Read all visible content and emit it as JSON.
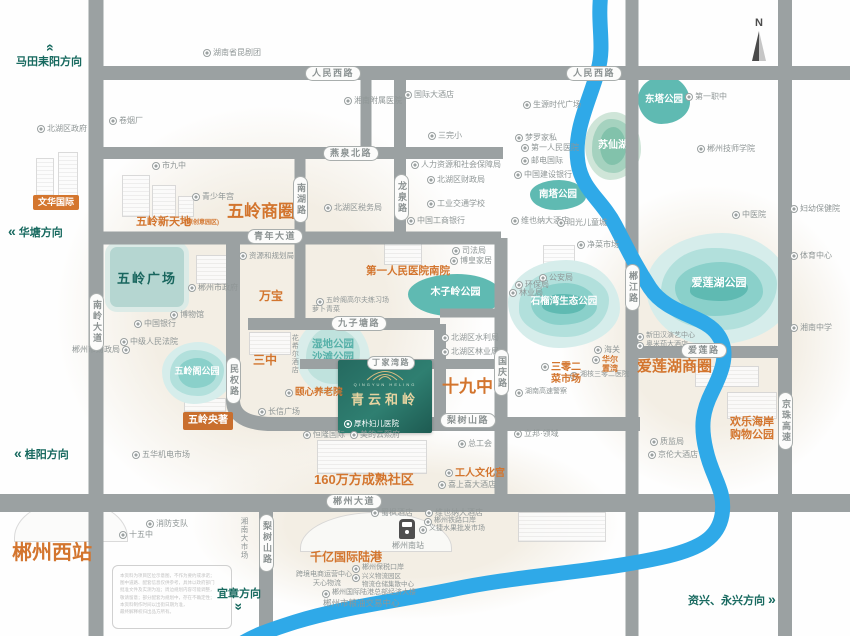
{
  "colors": {
    "road": "#9ba1a2",
    "river": "#2fa9e8",
    "orange": "#d3752e",
    "teal_dark": "#17695f",
    "park_palette": [
      "#d6edeb",
      "#b2e0dc",
      "#8ad0ca",
      "#5fbab2"
    ],
    "park_green": [
      "#cfe5d8",
      "#a5d2bf",
      "#82c2ab"
    ],
    "park_pale": [
      "#d9edea",
      "#bfe2dd"
    ]
  },
  "project": {
    "name": "青云和岭",
    "latin": "QINGYUN HELING",
    "hospital": "厚朴妇儿医院"
  },
  "compass": {
    "label": "N"
  },
  "road_pills": {
    "horizontal": [
      {
        "t": "人民西路",
        "x": 305,
        "y": 66
      },
      {
        "t": "人民西路",
        "x": 566,
        "y": 66
      },
      {
        "t": "燕泉北路",
        "x": 323,
        "y": 146
      },
      {
        "t": "青年大道",
        "x": 247,
        "y": 229
      },
      {
        "t": "九子塘路",
        "x": 331,
        "y": 316
      },
      {
        "t": "丁家湾路",
        "x": 367,
        "y": 356,
        "sm": 1
      },
      {
        "t": "梨树山路",
        "x": 440,
        "y": 413
      },
      {
        "t": "爱莲路",
        "x": 681,
        "y": 343
      },
      {
        "t": "郴州大道",
        "x": 326,
        "y": 494
      }
    ],
    "vertical": [
      {
        "t": "南岭大道",
        "x": 89,
        "y": 293
      },
      {
        "t": "南湖路",
        "x": 293,
        "y": 176
      },
      {
        "t": "龙泉路",
        "x": 394,
        "y": 174
      },
      {
        "t": "民权路",
        "x": 226,
        "y": 357
      },
      {
        "t": "国庆路",
        "x": 494,
        "y": 349
      },
      {
        "t": "郴江路",
        "x": 625,
        "y": 264
      },
      {
        "t": "京珠高速",
        "x": 778,
        "y": 392
      },
      {
        "t": "梨树山路",
        "x": 259,
        "y": 514
      }
    ]
  },
  "directions": [
    {
      "t": "马田耒阳方向",
      "x": 16,
      "y": 42,
      "dir": "up"
    },
    {
      "t": "华塘方向",
      "x": 8,
      "y": 224,
      "dir": "left"
    },
    {
      "t": "桂阳方向",
      "x": 14,
      "y": 446,
      "dir": "left"
    },
    {
      "t": "宜章方向",
      "x": 217,
      "y": 585,
      "dir": "down"
    },
    {
      "t": "资兴、永兴方向",
      "x": 688,
      "y": 592,
      "dir": "right"
    }
  ],
  "orange_labels": [
    {
      "t": "五岭商圈",
      "x": 227,
      "y": 202,
      "fs": 17
    },
    {
      "t": "爱莲湖商圈",
      "x": 637,
      "y": 358,
      "fs": 15
    },
    {
      "t": "十九中",
      "x": 442,
      "y": 377,
      "fs": 17
    },
    {
      "t": "郴州西站",
      "x": 12,
      "y": 542,
      "fs": 20
    },
    {
      "t": "160万方成熟社区",
      "x": 314,
      "y": 473,
      "fs": 13
    },
    {
      "t": "千亿国际陆港",
      "x": 310,
      "y": 551,
      "fs": 12
    },
    {
      "t": "五岭新天地",
      "x": 136,
      "y": 216,
      "fs": 11
    },
    {
      "t": "(原创意园区)",
      "x": 185,
      "y": 220,
      "fs": 6
    },
    {
      "t": "万宝",
      "x": 259,
      "y": 290,
      "fs": 12
    },
    {
      "t": "第一人民医院南院",
      "x": 366,
      "y": 265,
      "fs": 10.5
    },
    {
      "t": "三中",
      "x": 253,
      "y": 354,
      "fs": 12
    },
    {
      "t": "欢乐海岸\n购物公园",
      "x": 730,
      "y": 416,
      "fs": 11
    },
    {
      "t": "工人文化宫",
      "x": 445,
      "y": 468,
      "fs": 10,
      "icon": 1
    },
    {
      "t": "颐心养老院",
      "x": 285,
      "y": 388,
      "fs": 9.5,
      "icon": 1
    },
    {
      "t": "三零二\n菜市场",
      "x": 541,
      "y": 362,
      "fs": 10,
      "icon": 1
    },
    {
      "t": "华尔\n置湾",
      "x": 592,
      "y": 355,
      "fs": 8,
      "icon": 1
    }
  ],
  "pois": [
    {
      "t": "北湖区政府",
      "x": 37,
      "y": 124
    },
    {
      "t": "卷烟厂",
      "x": 109,
      "y": 116
    },
    {
      "t": "湖南省昆剧团",
      "x": 203,
      "y": 48
    },
    {
      "t": "市九中",
      "x": 152,
      "y": 161
    },
    {
      "t": "青少年宫",
      "x": 192,
      "y": 192
    },
    {
      "t": "湘南附属医院",
      "x": 344,
      "y": 96
    },
    {
      "t": "国际大酒店",
      "x": 404,
      "y": 90
    },
    {
      "t": "三完小",
      "x": 428,
      "y": 131
    },
    {
      "t": "人力资源和社会保障局",
      "x": 411,
      "y": 160
    },
    {
      "t": "北湖区财政局",
      "x": 427,
      "y": 175
    },
    {
      "t": "北湖区税务局",
      "x": 324,
      "y": 203
    },
    {
      "t": "工业交通学校",
      "x": 427,
      "y": 199
    },
    {
      "t": "中国工商银行",
      "x": 407,
      "y": 216
    },
    {
      "t": "生源时代广场",
      "x": 523,
      "y": 100
    },
    {
      "t": "梦罗家私",
      "x": 515,
      "y": 133
    },
    {
      "t": "第一人民医院",
      "x": 521,
      "y": 143
    },
    {
      "t": "邮电国际",
      "x": 521,
      "y": 156
    },
    {
      "t": "中国建设银行",
      "x": 514,
      "y": 170
    },
    {
      "t": "维也纳大酒店",
      "x": 511,
      "y": 216
    },
    {
      "t": "阳光儿童城",
      "x": 557,
      "y": 218
    },
    {
      "t": "第一职中",
      "x": 685,
      "y": 92
    },
    {
      "t": "郴州技师学院",
      "x": 697,
      "y": 144
    },
    {
      "t": "中医院",
      "x": 732,
      "y": 210
    },
    {
      "t": "妇幼保健院",
      "x": 790,
      "y": 204
    },
    {
      "t": "净菜市场",
      "x": 577,
      "y": 240
    },
    {
      "t": "体育中心",
      "x": 790,
      "y": 251
    },
    {
      "t": "湘南中学",
      "x": 790,
      "y": 323
    },
    {
      "t": "新田汉演艺中心",
      "x": 636,
      "y": 332,
      "fs": 7
    },
    {
      "t": "奥米茄大酒店",
      "x": 636,
      "y": 341,
      "fs": 7
    },
    {
      "t": "海关",
      "x": 594,
      "y": 345
    },
    {
      "t": "湘核三零二医院",
      "x": 570,
      "y": 371,
      "fs": 7
    },
    {
      "t": "湖南高速警察",
      "x": 515,
      "y": 388,
      "fs": 7
    },
    {
      "t": "司法局",
      "x": 452,
      "y": 246
    },
    {
      "t": "博皇家居",
      "x": 450,
      "y": 256
    },
    {
      "t": "公安局",
      "x": 539,
      "y": 273
    },
    {
      "t": "环保局",
      "x": 515,
      "y": 280
    },
    {
      "t": "林业局",
      "x": 509,
      "y": 288
    },
    {
      "t": "北湖区水利局",
      "x": 441,
      "y": 333
    },
    {
      "t": "北湖区林业局",
      "x": 441,
      "y": 347
    },
    {
      "t": "立邦·领域",
      "x": 514,
      "y": 429
    },
    {
      "t": "质监局",
      "x": 650,
      "y": 437
    },
    {
      "t": "京伦大酒店",
      "x": 648,
      "y": 450
    },
    {
      "t": "恒隆国际",
      "x": 303,
      "y": 430
    },
    {
      "t": "美的云熙府",
      "x": 350,
      "y": 430
    },
    {
      "t": "蜀枫酒店",
      "x": 371,
      "y": 508
    },
    {
      "t": "维也纳大酒店",
      "x": 425,
      "y": 508
    },
    {
      "t": "郴州铁路口岸",
      "x": 424,
      "y": 517,
      "fs": 7
    },
    {
      "t": "义捷水果批发市场",
      "x": 419,
      "y": 525,
      "fs": 7
    },
    {
      "t": "总工会",
      "x": 458,
      "y": 439
    },
    {
      "t": "喜上喜大酒店",
      "x": 438,
      "y": 480
    },
    {
      "t": "消防支队",
      "x": 146,
      "y": 519
    },
    {
      "t": "十五中",
      "x": 119,
      "y": 530
    },
    {
      "t": "长信广场",
      "x": 258,
      "y": 407
    },
    {
      "t": "中国银行",
      "x": 134,
      "y": 319
    },
    {
      "t": "博物馆",
      "x": 170,
      "y": 310
    },
    {
      "t": "郴州市政府",
      "x": 188,
      "y": 283
    },
    {
      "t": "中级人民法院",
      "x": 120,
      "y": 337
    },
    {
      "t": "郴州市财政局",
      "x": 72,
      "y": 345,
      "iconright": 1
    },
    {
      "t": "五华机电市场",
      "x": 132,
      "y": 450
    },
    {
      "t": "五岭阁高尔夫练习场",
      "x": 316,
      "y": 297,
      "fs": 7
    },
    {
      "t": "萝卜青菜",
      "x": 312,
      "y": 306,
      "fs": 7,
      "noicon": 1
    },
    {
      "t": "资源和规划局",
      "x": 239,
      "y": 251,
      "fs": 7.5
    },
    {
      "t": "郴州南站",
      "x": 392,
      "y": 541,
      "noicon": 1
    },
    {
      "t": "郴州保税口岸",
      "x": 352,
      "y": 564,
      "fs": 7
    },
    {
      "t": "跨境电商运营中心",
      "x": 296,
      "y": 571,
      "fs": 7,
      "noicon": 1
    },
    {
      "t": "天心物流",
      "x": 313,
      "y": 580,
      "fs": 7,
      "noicon": 1
    },
    {
      "t": "兴义物流园区\n物流仓储集散中心",
      "x": 352,
      "y": 573,
      "fs": 6.5
    },
    {
      "t": "郴州国际陆港总部经济大楼",
      "x": 322,
      "y": 589,
      "fs": 7
    },
    {
      "t": "郴州市粮油交易中心",
      "x": 323,
      "y": 598,
      "fs": 8.5,
      "noicon": 1
    },
    {
      "t": "湘南大市场",
      "x": 240,
      "y": 517,
      "v": 1,
      "noicon": 1,
      "fs": 7.5
    },
    {
      "t": "花希尔酒店",
      "x": 290,
      "y": 334,
      "v": 1,
      "noicon": 1,
      "fs": 7
    }
  ],
  "parks": [
    {
      "t": "爱莲湖公园",
      "x": 646,
      "y": 233,
      "w": 146,
      "h": 112,
      "layers": 4,
      "pal": "park_palette",
      "fs": 11,
      "lc": "#ffffff",
      "dy": 44
    },
    {
      "t": "石榴湾生态公园",
      "x": 508,
      "y": 260,
      "w": 112,
      "h": 88,
      "layers": 4,
      "pal": "park_palette",
      "fs": 9.5,
      "lc": "#ffffff",
      "dy": 36
    },
    {
      "t": "苏仙湖",
      "x": 585,
      "y": 112,
      "w": 56,
      "h": 68,
      "layers": 3,
      "pal": "park_green",
      "fs": 10,
      "lc": "#ffffff",
      "dy": 28
    },
    {
      "t": "东塔公园",
      "x": 638,
      "y": 76,
      "w": 52,
      "h": 48,
      "layers": 1,
      "pal": "park_palette",
      "fs": 9.5,
      "lc": "#ffffff",
      "dy": 18
    },
    {
      "t": "南塔公园",
      "x": 530,
      "y": 180,
      "w": 56,
      "h": 30,
      "layers": 1,
      "pal": "park_palette",
      "fs": 9.5,
      "lc": "#ffffff",
      "dy": 9
    },
    {
      "t": "木子岭公园",
      "x": 408,
      "y": 274,
      "w": 95,
      "h": 42,
      "layers": 1,
      "pal": "park_palette",
      "fs": 10,
      "lc": "#ffffff",
      "dy": 13
    },
    {
      "t": "五岭阁公园",
      "x": 162,
      "y": 342,
      "w": 70,
      "h": 62,
      "layers": 3,
      "pal": "park_palette",
      "fs": 9,
      "lc": "#ffffff",
      "dy": 24
    },
    {
      "t": "湿地公园\n沙滩公园",
      "x": 296,
      "y": 318,
      "w": 74,
      "h": 76,
      "layers": 2,
      "pal": "park_pale",
      "fs": 10.5,
      "lc": "#57b1a9",
      "dy": 20
    }
  ],
  "plaza": {
    "t": "五岭广场",
    "x": 105,
    "y": 242,
    "w": 74,
    "h": 60
  },
  "badges": [
    {
      "t": "文华国际",
      "x": 33,
      "y": 195,
      "bg": "#d4762e",
      "fs": 9,
      "pad": "3px 5px"
    },
    {
      "t": "五岭央著",
      "x": 183,
      "y": 412,
      "bg": "#c96f2e",
      "fs": 10,
      "pad": "4px 5px"
    }
  ],
  "disclaimer": {
    "text": "本资料为项目区位示意图，不作为要约或承诺；\n图中道路、配套信息仅供参考，具体以政府部门\n批准文件及实测为准；周边规划内容可能调整，\n敬请留意；部分配套为规划中，存在不确定性；\n本资料制作时间以出街日期为准，\n最终解释权归出品方所有。"
  }
}
